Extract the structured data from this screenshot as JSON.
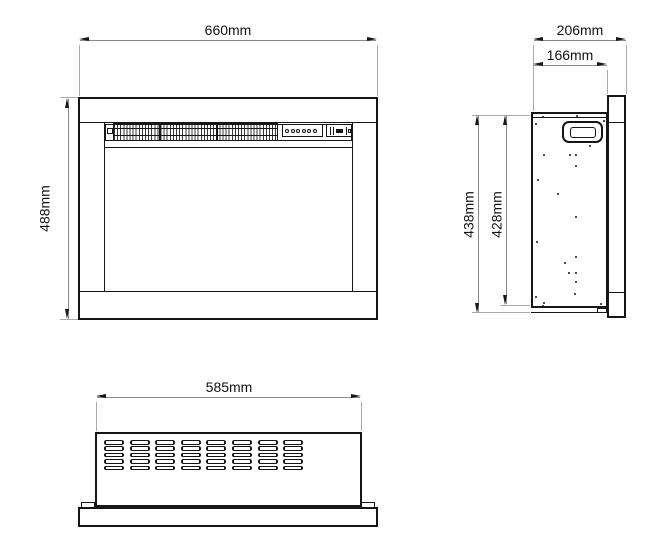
{
  "views": {
    "front": {
      "dim_width": "660mm",
      "dim_height": "488mm"
    },
    "side": {
      "dim_depth_overall": "206mm",
      "dim_depth_body": "166mm",
      "dim_height_overall": "438mm",
      "dim_height_body": "428mm"
    },
    "bottom": {
      "dim_width": "585mm"
    }
  },
  "drawing": {
    "control_button_count": 6,
    "vent_rows": 5,
    "vent_cols": 8,
    "screw_dots": [
      [
        543,
        117
      ],
      [
        577,
        116
      ],
      [
        536,
        124
      ],
      [
        604,
        121
      ],
      [
        544,
        155
      ],
      [
        570,
        155
      ],
      [
        576,
        155
      ],
      [
        576,
        166
      ],
      [
        538,
        180
      ],
      [
        590,
        146
      ],
      [
        558,
        194
      ],
      [
        576,
        217
      ],
      [
        537,
        242
      ],
      [
        576,
        257
      ],
      [
        565,
        263
      ],
      [
        569,
        273
      ],
      [
        576,
        273
      ],
      [
        576,
        282
      ],
      [
        536,
        297
      ],
      [
        575,
        294
      ],
      [
        543,
        306
      ],
      [
        544,
        303
      ],
      [
        601,
        304
      ]
    ]
  },
  "colors": {
    "line": "#161616",
    "dimension": "#8a8a8a",
    "extension": "#aaaaaa",
    "background": "#ffffff"
  }
}
